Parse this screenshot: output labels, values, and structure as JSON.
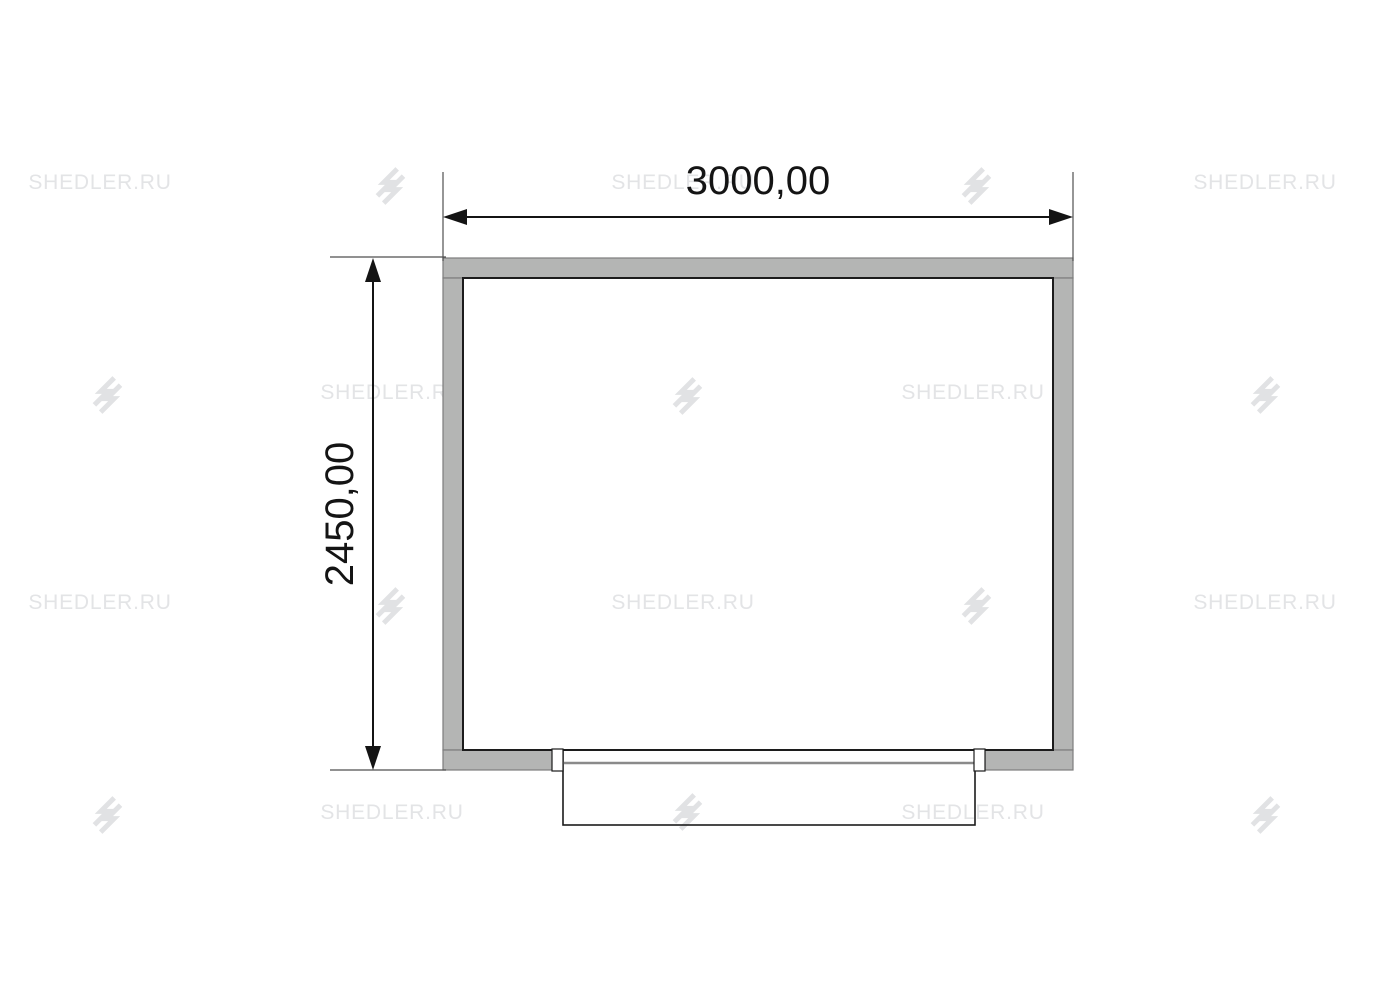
{
  "watermarks": {
    "text": "SHEDLER.RU",
    "color": "#e3e4e6",
    "icon_name": "shedler-logo-icon",
    "items": [
      {
        "type": "text",
        "x": 100,
        "y": 183
      },
      {
        "type": "icon",
        "x": 390,
        "y": 186
      },
      {
        "type": "text",
        "x": 683,
        "y": 183
      },
      {
        "type": "icon",
        "x": 976,
        "y": 186
      },
      {
        "type": "text",
        "x": 1265,
        "y": 183
      },
      {
        "type": "icon",
        "x": 107,
        "y": 395
      },
      {
        "type": "text",
        "x": 392,
        "y": 393
      },
      {
        "type": "icon",
        "x": 687,
        "y": 396
      },
      {
        "type": "text",
        "x": 973,
        "y": 393
      },
      {
        "type": "icon",
        "x": 1265,
        "y": 395
      },
      {
        "type": "text",
        "x": 100,
        "y": 603
      },
      {
        "type": "icon",
        "x": 390,
        "y": 606
      },
      {
        "type": "text",
        "x": 683,
        "y": 603
      },
      {
        "type": "icon",
        "x": 976,
        "y": 606
      },
      {
        "type": "text",
        "x": 1265,
        "y": 603
      },
      {
        "type": "icon",
        "x": 107,
        "y": 815
      },
      {
        "type": "text",
        "x": 392,
        "y": 813
      },
      {
        "type": "icon",
        "x": 687,
        "y": 812
      },
      {
        "type": "text",
        "x": 973,
        "y": 813
      },
      {
        "type": "icon",
        "x": 1265,
        "y": 815
      }
    ]
  },
  "plan": {
    "wall_fill": "#b4b5b4",
    "wall_edge_color": "#7d7d7d",
    "inner_line_color": "#1c1c1c",
    "dimension_color": "#141414",
    "extension_color": "#4f4f4f",
    "platform_line_color": "#8a8a8a"
  },
  "dimensions": {
    "width_label": "3000,00",
    "height_label": "2450,00"
  }
}
